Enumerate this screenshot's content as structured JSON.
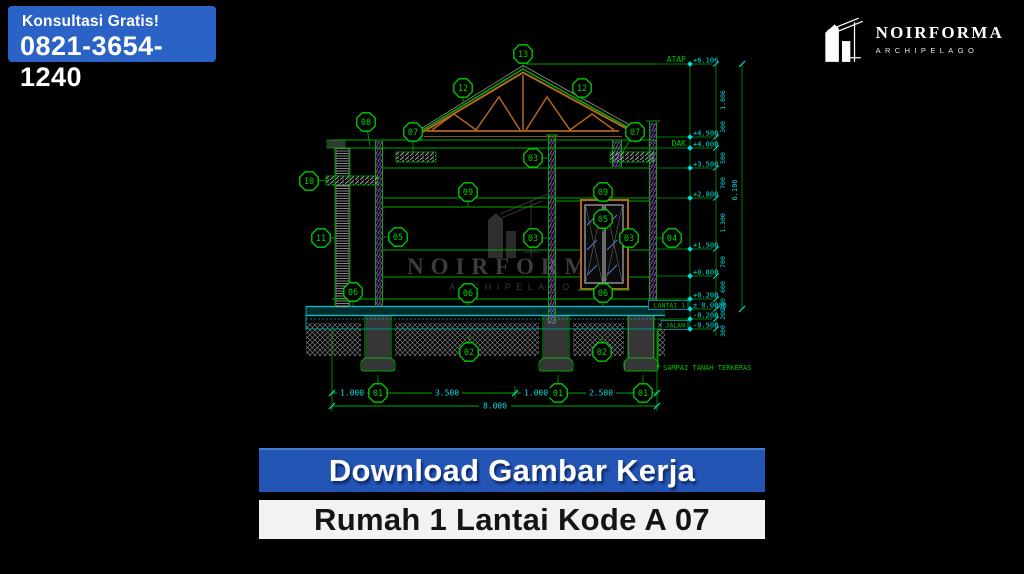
{
  "badge": {
    "line1": "Konsultasi Gratis!",
    "phone": "0821-3654-1240",
    "bg": "#2b62c6"
  },
  "logo": {
    "name": "NOIRFORMA",
    "subtitle": "ARCHIPELAGO"
  },
  "watermark": {
    "name": "NOIRFORMA",
    "subtitle": "ARCHIPELAGO"
  },
  "banners": {
    "download": {
      "label": "Download Gambar Kerja",
      "bg": "#2355b5",
      "fg": "#ffffff"
    },
    "product": {
      "label": "Rumah 1 Lantai Kode A 07",
      "bg": "#f2f2f2",
      "fg": "#141414"
    }
  },
  "colors": {
    "cad_green": "#00a800",
    "marker_green": "#00d000",
    "cad_cyan": "#00dede",
    "truss_orange": "#b06820"
  },
  "drawing": {
    "levels": [
      {
        "name": "ATAP",
        "value": "+6.106",
        "y": 64
      },
      {
        "value": "+4.500",
        "y": 137
      },
      {
        "name": "DAK",
        "value": "+4.000",
        "y": 148
      },
      {
        "value": "+3.500",
        "y": 168
      },
      {
        "value": "+2.800",
        "y": 198
      },
      {
        "value": "+1.500",
        "y": 249
      },
      {
        "value": "+0.800",
        "y": 276
      },
      {
        "value": "+0.200",
        "y": 299
      },
      {
        "name": "LANTAI 1",
        "value": "± 0.0000",
        "y": 309,
        "boxed": true
      },
      {
        "value": "-0.200",
        "y": 319
      },
      {
        "name": "JALAN",
        "value": "-0.500",
        "y": 329,
        "boxed": true
      }
    ],
    "vdims": [
      {
        "t": "1.806",
        "y": 100
      },
      {
        "t": "300",
        "y": 127
      },
      {
        "t": "500",
        "y": 158
      },
      {
        "t": "700",
        "y": 183
      },
      {
        "t": "1.300",
        "y": 223
      },
      {
        "t": "700",
        "y": 262
      },
      {
        "t": "600",
        "y": 287
      },
      {
        "t": "200",
        "y": 304
      },
      {
        "t": "200",
        "y": 314
      },
      {
        "t": "300",
        "y": 331
      }
    ],
    "overall_height": "6.106",
    "markers": [
      {
        "label": "13",
        "x": 523,
        "y": 54,
        "tx": 523,
        "ty": 68
      },
      {
        "label": "12",
        "x": 463,
        "y": 88,
        "tx": 463,
        "ty": 104
      },
      {
        "label": "12",
        "x": 582,
        "y": 88,
        "tx": 582,
        "ty": 104
      },
      {
        "label": "08",
        "x": 366,
        "y": 122,
        "tx": 370,
        "ty": 146
      },
      {
        "label": "07",
        "x": 413,
        "y": 132,
        "tx": 413,
        "ty": 153
      },
      {
        "label": "07",
        "x": 635,
        "y": 132,
        "tx": 622,
        "ty": 153
      },
      {
        "label": "03",
        "x": 533,
        "y": 158,
        "tx": 550,
        "ty": 158
      },
      {
        "label": "10",
        "x": 309,
        "y": 181,
        "tx": 330,
        "ty": 180
      },
      {
        "label": "09",
        "x": 468,
        "y": 192,
        "tx": 468,
        "ty": 207
      },
      {
        "label": "09",
        "x": 603,
        "y": 192,
        "tx": 603,
        "ty": 201
      },
      {
        "label": "05",
        "x": 603,
        "y": 219,
        "tx": 603,
        "ty": 232
      },
      {
        "label": "03",
        "x": 533,
        "y": 238,
        "tx": 550,
        "ty": 238
      },
      {
        "label": "03",
        "x": 629,
        "y": 238,
        "tx": 627,
        "ty": 238
      },
      {
        "label": "04",
        "x": 672,
        "y": 238,
        "tx": 656,
        "ty": 238
      },
      {
        "label": "11",
        "x": 321,
        "y": 238,
        "tx": 336,
        "ty": 238
      },
      {
        "label": "05",
        "x": 398,
        "y": 237,
        "tx": 383,
        "ty": 237
      },
      {
        "label": "06",
        "x": 353,
        "y": 292,
        "tx": 353,
        "ty": 306
      },
      {
        "label": "06",
        "x": 468,
        "y": 293,
        "tx": 468,
        "ty": 307
      },
      {
        "label": "06",
        "x": 603,
        "y": 293,
        "tx": 603,
        "ty": 307
      },
      {
        "label": "02",
        "x": 469,
        "y": 352,
        "tx": 469,
        "ty": 336
      },
      {
        "label": "02",
        "x": 602,
        "y": 352,
        "tx": 602,
        "ty": 336
      },
      {
        "label": "01",
        "x": 378,
        "y": 393,
        "tx": 378,
        "ty": 375
      },
      {
        "label": "01",
        "x": 558,
        "y": 393,
        "tx": 558,
        "ty": 375
      },
      {
        "label": "01",
        "x": 643,
        "y": 393,
        "tx": 643,
        "ty": 375
      }
    ],
    "hdims": [
      {
        "t": "1.000",
        "x": 352
      },
      {
        "t": "3.500",
        "x": 447
      },
      {
        "t": "1.000",
        "x": 536
      },
      {
        "t": "2.500",
        "x": 601
      }
    ],
    "total_width": "8.000",
    "ground_note": "SAMPAI TANAH TERKERAS"
  }
}
